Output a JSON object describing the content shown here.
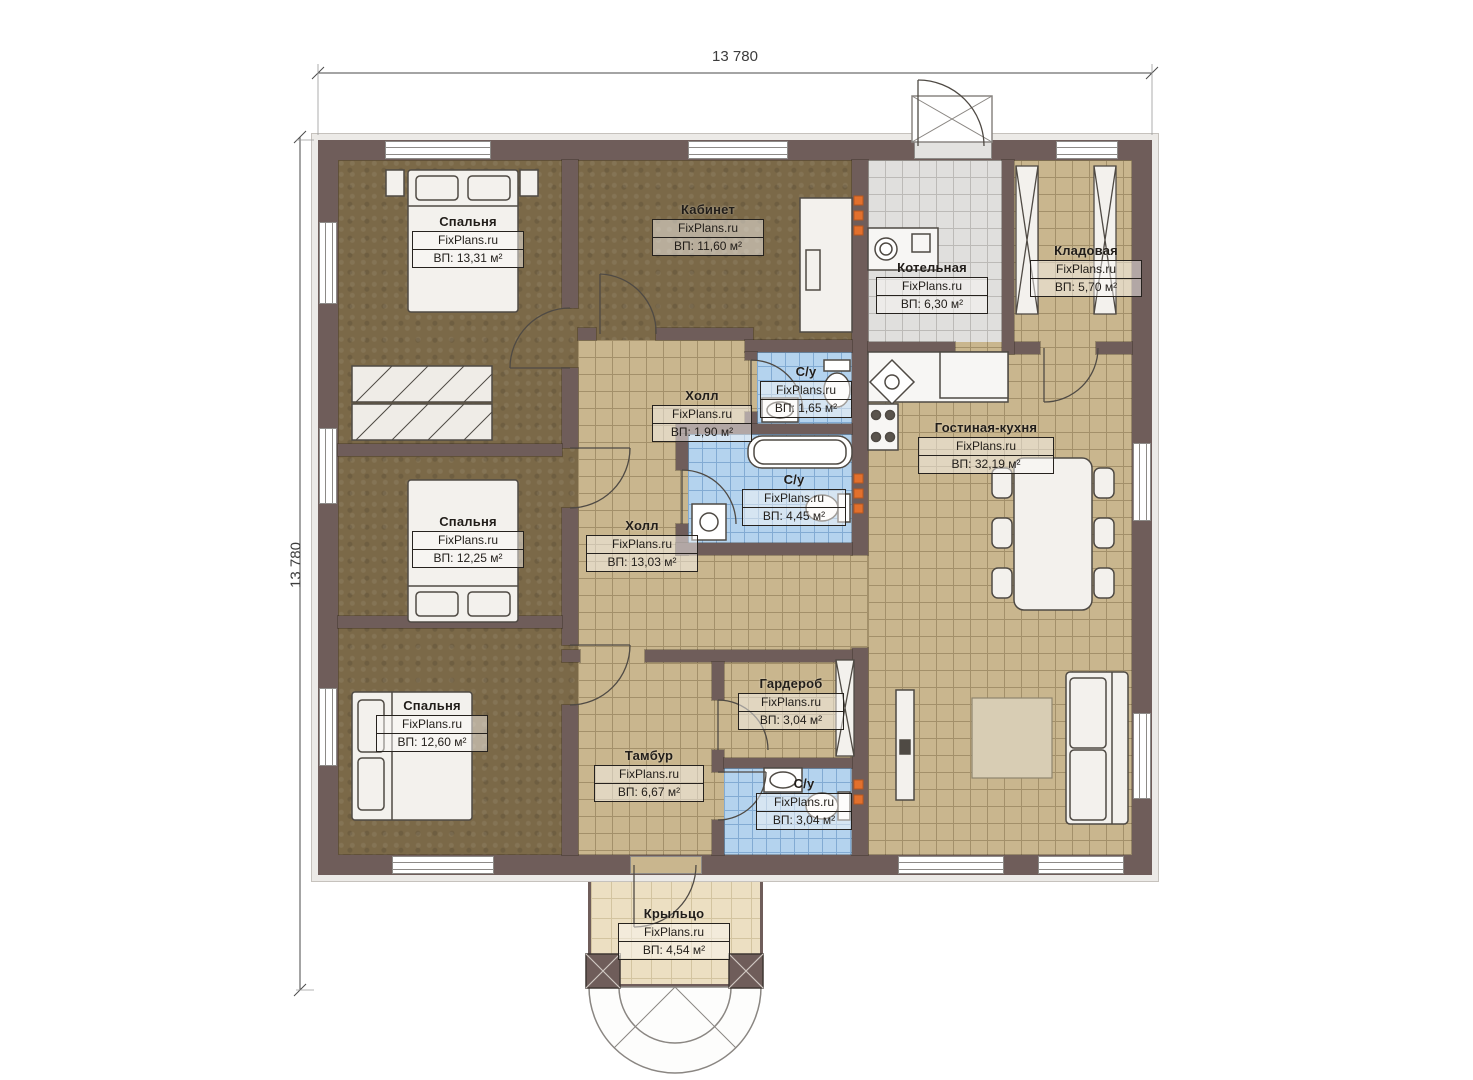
{
  "dimensions": {
    "width": "13 780",
    "height": "13 780"
  },
  "rooms": {
    "bedroom1": {
      "name": "Спальня",
      "brand": "FixPlans.ru",
      "area": "ВП: 13,31 м²"
    },
    "bedroom2": {
      "name": "Спальня",
      "brand": "FixPlans.ru",
      "area": "ВП: 12,25 м²"
    },
    "bedroom3": {
      "name": "Спальня",
      "brand": "FixPlans.ru",
      "area": "ВП: 12,60 м²"
    },
    "office": {
      "name": "Кабинет",
      "brand": "FixPlans.ru",
      "area": "ВП: 11,60 м²"
    },
    "boiler": {
      "name": "Котельная",
      "brand": "FixPlans.ru",
      "area": "ВП: 6,30 м²"
    },
    "pantry": {
      "name": "Кладовая",
      "brand": "FixPlans.ru",
      "area": "ВП: 5,70 м²"
    },
    "hall_small": {
      "name": "Холл",
      "brand": "FixPlans.ru",
      "area": "ВП: 1,90 м²"
    },
    "wc_top": {
      "name": "С/у",
      "brand": "FixPlans.ru",
      "area": "ВП: 1,65 м²"
    },
    "hall_main": {
      "name": "Холл",
      "brand": "FixPlans.ru",
      "area": "ВП: 13,03 м²"
    },
    "bathroom": {
      "name": "С/у",
      "brand": "FixPlans.ru",
      "area": "ВП: 4,45 м²"
    },
    "living_kitchen": {
      "name": "Гостиная-кухня",
      "brand": "FixPlans.ru",
      "area": "ВП: 32,19 м²"
    },
    "wardrobe": {
      "name": "Гардероб",
      "brand": "FixPlans.ru",
      "area": "ВП: 3,04 м²"
    },
    "vestibule": {
      "name": "Тамбур",
      "brand": "FixPlans.ru",
      "area": "ВП: 6,67 м²"
    },
    "wc_bottom": {
      "name": "С/у",
      "brand": "FixPlans.ru",
      "area": "ВП: 3,04 м²"
    },
    "porch": {
      "name": "Крыльцо",
      "brand": "FixPlans.ru",
      "area": "ВП: 4,54 м²"
    }
  },
  "colors": {
    "wall": "#6f5d5a",
    "floor_wood": "#7b6948",
    "tile_tan": "#c9b68e",
    "tile_blue": "#b4d3ee",
    "tile_gray": "#e0dfdd",
    "porch": "#ecdfc2",
    "radiator": "#e2702d",
    "line": "#4a4540"
  }
}
